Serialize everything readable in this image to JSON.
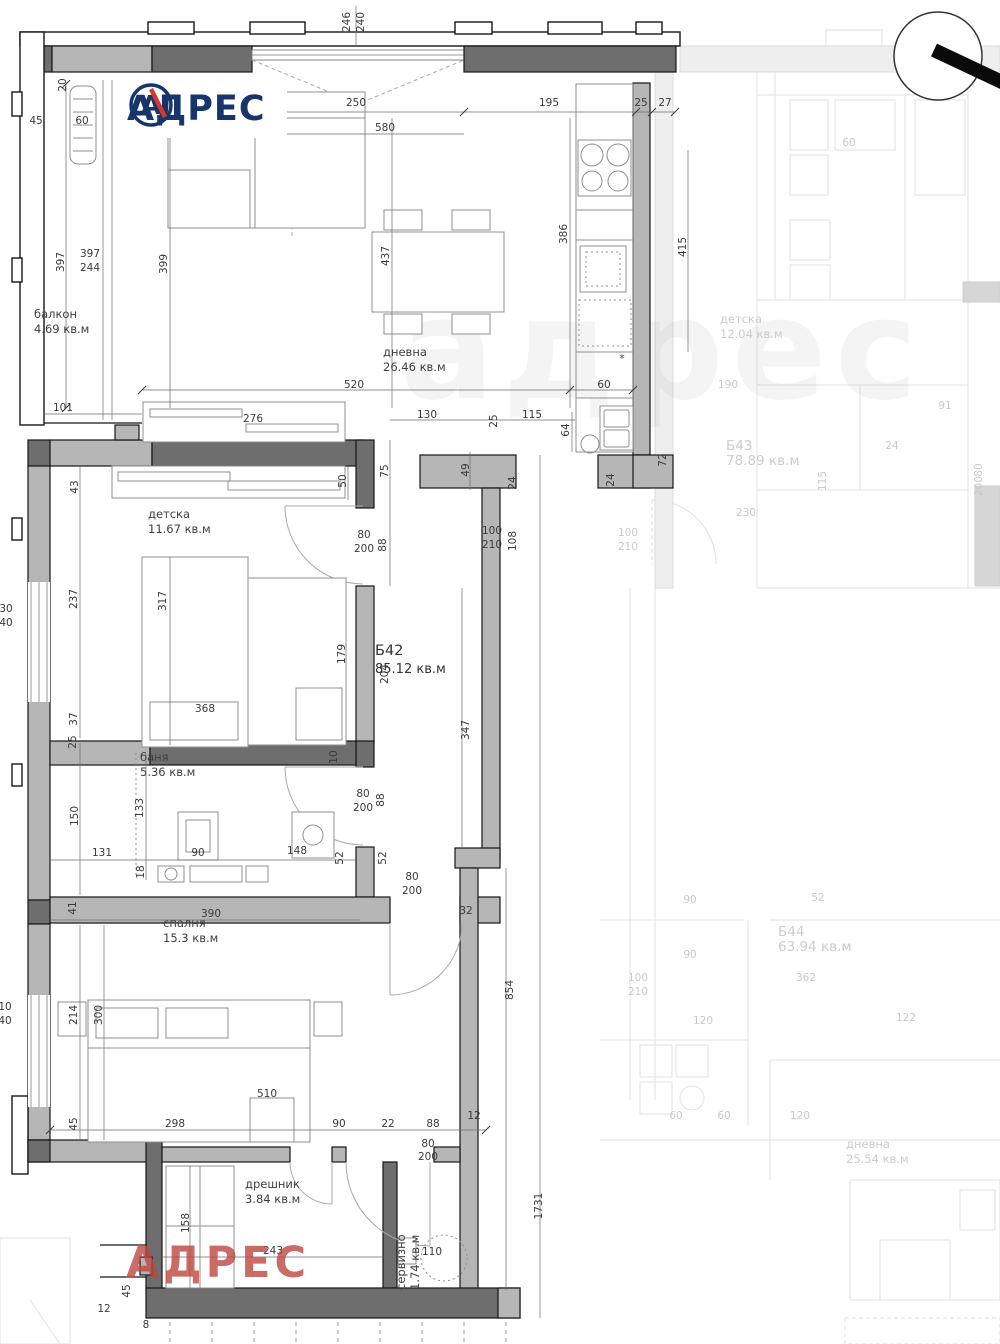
{
  "brand": {
    "logo_text": "АДРЕС",
    "logo_letter": "А",
    "watermark_text": "АДРЕС",
    "ghost_watermark": "адрес",
    "navy": "#17356b",
    "red": "#d33a2f",
    "watermark_red": "#be463e"
  },
  "unit_label": {
    "id": "Б42",
    "area": "85.12 кв.м",
    "x": 375,
    "y": 655
  },
  "room_labels": [
    {
      "name": "балкон",
      "area": "4.69 кв.м",
      "x": 34,
      "y": 318
    },
    {
      "name": "дневна",
      "area": "26.46 кв.м",
      "x": 383,
      "y": 356
    },
    {
      "name": "детска",
      "area": "11.67 кв.м",
      "x": 148,
      "y": 518
    },
    {
      "name": "баня",
      "area": "5.36 кв.м",
      "x": 140,
      "y": 761
    },
    {
      "name": "спалня",
      "area": "15.3 кв.м",
      "x": 163,
      "y": 927
    },
    {
      "name": "дрешник",
      "area": "3.84 кв.м",
      "x": 245,
      "y": 1188
    },
    {
      "name": "сервизно",
      "area": "1.74 кв.м",
      "x": 405,
      "y": 1290,
      "rot": -90
    },
    {
      "name": "детска",
      "area": "12.04 кв.м",
      "x": 720,
      "y": 323,
      "faded": true
    },
    {
      "name": "Б43",
      "area": "78.89 кв.м",
      "x": 726,
      "y": 450,
      "faded": true,
      "big": true
    },
    {
      "name": "Б44",
      "area": "63.94 кв.м",
      "x": 778,
      "y": 936,
      "faded": true,
      "big": true
    },
    {
      "name": "дневна",
      "area": "25.54 кв.м",
      "x": 846,
      "y": 1148,
      "faded": true
    }
  ],
  "dims": [
    {
      "t": "246",
      "x": 350,
      "y": 22,
      "r": -90
    },
    {
      "t": "240",
      "x": 364,
      "y": 22,
      "r": -90
    },
    {
      "t": "250",
      "x": 356,
      "y": 106
    },
    {
      "t": "195",
      "x": 549,
      "y": 106
    },
    {
      "t": "25",
      "x": 641,
      "y": 106
    },
    {
      "t": "27",
      "x": 665,
      "y": 106
    },
    {
      "t": "580",
      "x": 385,
      "y": 131
    },
    {
      "t": "20",
      "x": 66,
      "y": 85,
      "r": -90
    },
    {
      "t": "45",
      "x": 36,
      "y": 124
    },
    {
      "t": "60",
      "x": 82,
      "y": 124
    },
    {
      "t": "397",
      "x": 64,
      "y": 262,
      "r": -90
    },
    {
      "t": "397",
      "x": 90,
      "y": 257
    },
    {
      "t": "244",
      "x": 90,
      "y": 271
    },
    {
      "t": "399",
      "x": 167,
      "y": 264,
      "r": -90
    },
    {
      "t": "437",
      "x": 389,
      "y": 256,
      "r": -90
    },
    {
      "t": "386",
      "x": 567,
      "y": 234,
      "r": -90
    },
    {
      "t": "415",
      "x": 686,
      "y": 247,
      "r": -90
    },
    {
      "t": "101",
      "x": 63,
      "y": 411
    },
    {
      "t": "520",
      "x": 354,
      "y": 388
    },
    {
      "t": "60",
      "x": 604,
      "y": 388
    },
    {
      "t": "276",
      "x": 253,
      "y": 422
    },
    {
      "t": "130",
      "x": 427,
      "y": 418
    },
    {
      "t": "115",
      "x": 532,
      "y": 418
    },
    {
      "t": "64",
      "x": 569,
      "y": 430,
      "r": -90
    },
    {
      "t": "25",
      "x": 497,
      "y": 421,
      "r": -90
    },
    {
      "t": "43",
      "x": 78,
      "y": 487,
      "r": -90
    },
    {
      "t": "50",
      "x": 346,
      "y": 481,
      "r": -90
    },
    {
      "t": "75",
      "x": 388,
      "y": 471,
      "r": -90
    },
    {
      "t": "49",
      "x": 469,
      "y": 470,
      "r": -90
    },
    {
      "t": "24",
      "x": 516,
      "y": 483,
      "r": -90
    },
    {
      "t": "24",
      "x": 614,
      "y": 480,
      "r": -90
    },
    {
      "t": "72",
      "x": 666,
      "y": 460,
      "r": -90
    },
    {
      "t": "80",
      "x": 364,
      "y": 538
    },
    {
      "t": "200",
      "x": 364,
      "y": 552
    },
    {
      "t": "88",
      "x": 386,
      "y": 545,
      "r": -90
    },
    {
      "t": "100",
      "x": 492,
      "y": 534
    },
    {
      "t": "210",
      "x": 492,
      "y": 548
    },
    {
      "t": "108",
      "x": 516,
      "y": 541,
      "r": -90
    },
    {
      "t": "30",
      "x": 6,
      "y": 612
    },
    {
      "t": "40",
      "x": 6,
      "y": 626
    },
    {
      "t": "237",
      "x": 77,
      "y": 599,
      "r": -90
    },
    {
      "t": "317",
      "x": 166,
      "y": 601,
      "r": -90
    },
    {
      "t": "179",
      "x": 345,
      "y": 654,
      "r": -90
    },
    {
      "t": "204",
      "x": 388,
      "y": 674,
      "r": -90
    },
    {
      "t": "347",
      "x": 469,
      "y": 730,
      "r": -90
    },
    {
      "t": "368",
      "x": 205,
      "y": 712
    },
    {
      "t": "37",
      "x": 77,
      "y": 719,
      "r": -90
    },
    {
      "t": "25",
      "x": 76,
      "y": 742,
      "r": -90
    },
    {
      "t": "10",
      "x": 337,
      "y": 757,
      "r": -90
    },
    {
      "t": "80",
      "x": 363,
      "y": 797
    },
    {
      "t": "200",
      "x": 363,
      "y": 811
    },
    {
      "t": "88",
      "x": 384,
      "y": 800,
      "r": -90
    },
    {
      "t": "150",
      "x": 78,
      "y": 816,
      "r": -90
    },
    {
      "t": "133",
      "x": 143,
      "y": 808,
      "r": -90
    },
    {
      "t": "18",
      "x": 144,
      "y": 872,
      "r": -90
    },
    {
      "t": "131",
      "x": 102,
      "y": 856
    },
    {
      "t": "90",
      "x": 198,
      "y": 856
    },
    {
      "t": "148",
      "x": 297,
      "y": 854
    },
    {
      "t": "52",
      "x": 343,
      "y": 858,
      "r": -90
    },
    {
      "t": "52",
      "x": 386,
      "y": 858,
      "r": -90
    },
    {
      "t": "41",
      "x": 76,
      "y": 908,
      "r": -90
    },
    {
      "t": "390",
      "x": 211,
      "y": 917
    },
    {
      "t": "80",
      "x": 412,
      "y": 880
    },
    {
      "t": "200",
      "x": 412,
      "y": 894
    },
    {
      "t": "32",
      "x": 466,
      "y": 914
    },
    {
      "t": "854",
      "x": 513,
      "y": 990,
      "r": -90
    },
    {
      "t": "214",
      "x": 77,
      "y": 1015,
      "r": -90
    },
    {
      "t": "300",
      "x": 102,
      "y": 1015,
      "r": -90
    },
    {
      "t": "10",
      "x": 5,
      "y": 1010
    },
    {
      "t": "40",
      "x": 5,
      "y": 1024
    },
    {
      "t": "510",
      "x": 267,
      "y": 1097
    },
    {
      "t": "45",
      "x": 77,
      "y": 1124,
      "r": -90
    },
    {
      "t": "298",
      "x": 175,
      "y": 1127
    },
    {
      "t": "90",
      "x": 339,
      "y": 1127
    },
    {
      "t": "22",
      "x": 388,
      "y": 1127
    },
    {
      "t": "88",
      "x": 433,
      "y": 1127
    },
    {
      "t": "12",
      "x": 474,
      "y": 1119
    },
    {
      "t": "80",
      "x": 428,
      "y": 1147
    },
    {
      "t": "200",
      "x": 428,
      "y": 1160
    },
    {
      "t": "158",
      "x": 189,
      "y": 1223,
      "r": -90
    },
    {
      "t": "243",
      "x": 273,
      "y": 1254
    },
    {
      "t": "110",
      "x": 432,
      "y": 1255
    },
    {
      "t": "1731",
      "x": 542,
      "y": 1206,
      "r": -90
    },
    {
      "t": "45",
      "x": 130,
      "y": 1291,
      "r": -90
    },
    {
      "t": "12",
      "x": 104,
      "y": 1312
    },
    {
      "t": "8",
      "x": 146,
      "y": 1328
    },
    {
      "t": "*",
      "x": 622,
      "y": 362
    },
    {
      "t": "60",
      "x": 849,
      "y": 146,
      "f": true
    },
    {
      "t": "190",
      "x": 728,
      "y": 388,
      "f": true
    },
    {
      "t": "91",
      "x": 945,
      "y": 409,
      "f": true
    },
    {
      "t": "24",
      "x": 892,
      "y": 449,
      "f": true
    },
    {
      "t": "230",
      "x": 746,
      "y": 516,
      "f": true
    },
    {
      "t": "115",
      "x": 826,
      "y": 481,
      "r": -90,
      "f": true
    },
    {
      "t": "100",
      "x": 628,
      "y": 536,
      "f": true
    },
    {
      "t": "210",
      "x": 628,
      "y": 550,
      "f": true
    },
    {
      "t": "80",
      "x": 982,
      "y": 470,
      "r": -90,
      "f": true
    },
    {
      "t": "200",
      "x": 982,
      "y": 486,
      "r": -90,
      "f": true
    },
    {
      "t": "90",
      "x": 690,
      "y": 903,
      "f": true
    },
    {
      "t": "90",
      "x": 690,
      "y": 958,
      "f": true
    },
    {
      "t": "52",
      "x": 818,
      "y": 901,
      "f": true
    },
    {
      "t": "362",
      "x": 806,
      "y": 981,
      "f": true
    },
    {
      "t": "100",
      "x": 638,
      "y": 981,
      "f": true
    },
    {
      "t": "210",
      "x": 638,
      "y": 995,
      "f": true
    },
    {
      "t": "120",
      "x": 703,
      "y": 1024,
      "f": true
    },
    {
      "t": "122",
      "x": 906,
      "y": 1021,
      "f": true
    },
    {
      "t": "60",
      "x": 676,
      "y": 1119,
      "f": true
    },
    {
      "t": "60",
      "x": 724,
      "y": 1119,
      "f": true
    },
    {
      "t": "120",
      "x": 800,
      "y": 1119,
      "f": true
    }
  ]
}
